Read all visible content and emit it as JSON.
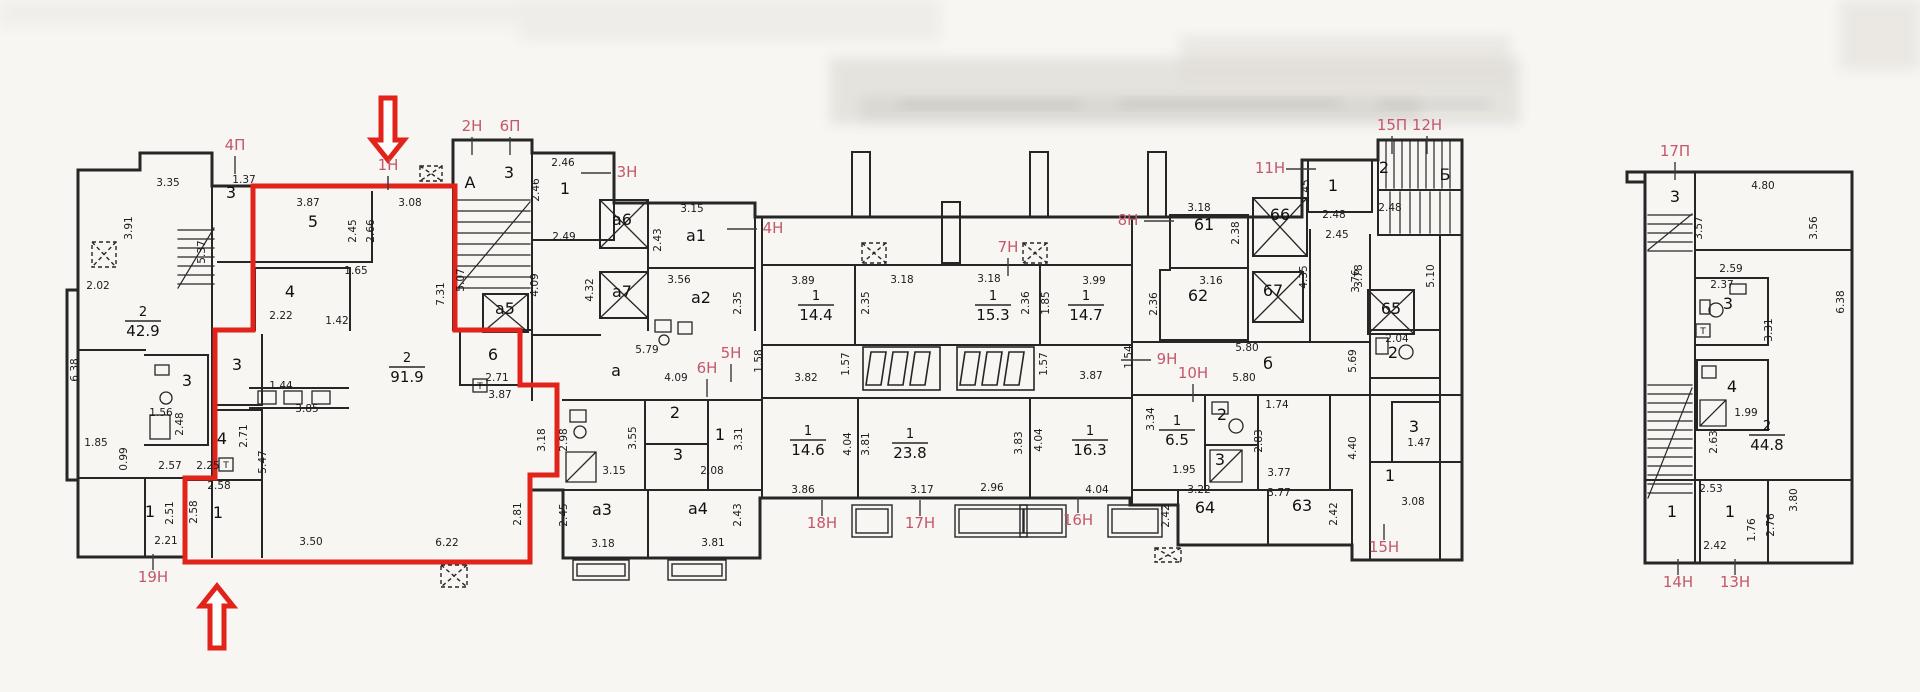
{
  "document": {
    "kind": "scanned floor plan"
  },
  "colors": {
    "paper": "#f7f6f3",
    "wall": "#262626",
    "red": "#e2231a",
    "red_label": "#c4576a",
    "tick": "#3a3a3a"
  },
  "plan": {
    "unit_outline": "M253,186 L455,186 L455,330 L520,330 L520,385 L557,385 L557,475 L530,475 L530,562 L185,562 L185,478 L215,478 L215,330 L253,330 Z",
    "arrows": [
      {
        "x": 388,
        "y": 98,
        "len": 62,
        "dir": "down"
      },
      {
        "x": 217,
        "y": 648,
        "len": 62,
        "dir": "up"
      }
    ],
    "red_labels": [
      [
        "4П",
        235,
        150,
        "d"
      ],
      [
        "2Н",
        472,
        131,
        "d"
      ],
      [
        "6П",
        510,
        131,
        "d"
      ],
      [
        "1Н",
        388,
        170,
        ""
      ],
      [
        "3Н",
        627,
        177,
        "l"
      ],
      [
        "4Н",
        773,
        233,
        "l"
      ],
      [
        "5Н",
        731,
        358,
        "d"
      ],
      [
        "6Н",
        707,
        373,
        "d"
      ],
      [
        "7Н",
        1008,
        252,
        "d"
      ],
      [
        "8Н",
        1128,
        225,
        "r"
      ],
      [
        "9Н",
        1167,
        364,
        "l"
      ],
      [
        "10Н",
        1193,
        378,
        "d"
      ],
      [
        "11Н",
        1270,
        173,
        "r"
      ],
      [
        "15П",
        1392,
        130,
        "d"
      ],
      [
        "12Н",
        1427,
        130,
        "d"
      ],
      [
        "16Н",
        1078,
        525,
        "u"
      ],
      [
        "17Н",
        920,
        528,
        "u"
      ],
      [
        "18Н",
        822,
        528,
        "u"
      ],
      [
        "19Н",
        153,
        582,
        "u"
      ],
      [
        "15Н",
        1384,
        552,
        "u"
      ],
      [
        "17П",
        1675,
        156,
        "d"
      ],
      [
        "14Н",
        1678,
        587,
        "u"
      ],
      [
        "13Н",
        1735,
        587,
        "u"
      ]
    ],
    "rooms": [
      [
        "3",
        231,
        198
      ],
      [
        "3",
        187,
        386
      ],
      [
        "1",
        150,
        517
      ],
      [
        "5",
        313,
        227
      ],
      [
        "4",
        290,
        297
      ],
      [
        "3",
        237,
        370
      ],
      [
        "4",
        222,
        444
      ],
      [
        "1",
        218,
        518
      ],
      [
        "6",
        493,
        360
      ],
      [
        "А",
        470,
        188
      ],
      [
        "3",
        509,
        178
      ],
      [
        "1",
        565,
        194
      ],
      [
        "а5",
        505,
        314
      ],
      [
        "а6",
        622,
        225
      ],
      [
        "а7",
        622,
        297
      ],
      [
        "а1",
        696,
        241
      ],
      [
        "а2",
        701,
        303
      ],
      [
        "а",
        616,
        376
      ],
      [
        "а3",
        602,
        515
      ],
      [
        "а4",
        698,
        514
      ],
      [
        "2",
        675,
        418
      ],
      [
        "3",
        678,
        460
      ],
      [
        "1",
        720,
        440
      ],
      [
        "61",
        1204,
        230
      ],
      [
        "62",
        1198,
        301
      ],
      [
        "66",
        1280,
        220
      ],
      [
        "67",
        1273,
        296
      ],
      [
        "65",
        1391,
        314
      ],
      [
        "64",
        1205,
        513
      ],
      [
        "63",
        1302,
        511
      ],
      [
        "б",
        1268,
        369
      ],
      [
        "1",
        1333,
        191
      ],
      [
        "2",
        1222,
        420
      ],
      [
        "3",
        1220,
        465
      ],
      [
        "2",
        1393,
        358
      ],
      [
        "3",
        1414,
        432
      ],
      [
        "1",
        1390,
        481
      ],
      [
        "Б",
        1445,
        180
      ],
      [
        "2",
        1384,
        173
      ],
      [
        "3",
        1675,
        202
      ],
      [
        "3",
        1728,
        309
      ],
      [
        "4",
        1732,
        392
      ],
      [
        "1",
        1672,
        517
      ],
      [
        "1",
        1730,
        517
      ]
    ],
    "areas": [
      [
        "2",
        "42.9",
        143,
        316
      ],
      [
        "2",
        "91.9",
        407,
        362
      ],
      [
        "1",
        "14.4",
        816,
        300
      ],
      [
        "1",
        "15.3",
        993,
        300
      ],
      [
        "1",
        "14.7",
        1086,
        300
      ],
      [
        "1",
        "14.6",
        808,
        435
      ],
      [
        "1",
        "23.8",
        910,
        438
      ],
      [
        "1",
        "16.3",
        1090,
        435
      ],
      [
        "1",
        "6.5",
        1177,
        425
      ],
      [
        "2",
        "44.8",
        1767,
        430
      ]
    ],
    "dims": [
      [
        "3.35",
        168,
        186,
        0
      ],
      [
        "1.37",
        244,
        183,
        0
      ],
      [
        "3.91",
        132,
        228,
        1
      ],
      [
        "5.37",
        205,
        252,
        1
      ],
      [
        "2.02",
        98,
        289,
        0
      ],
      [
        "6.38",
        78,
        370,
        1
      ],
      [
        "1.85",
        96,
        446,
        0
      ],
      [
        "0.99",
        127,
        459,
        1
      ],
      [
        "2.57",
        170,
        469,
        0
      ],
      [
        "2.48",
        183,
        424,
        1
      ],
      [
        "1.56",
        161,
        416,
        0
      ],
      [
        "2.51",
        173,
        513,
        1
      ],
      [
        "2.21",
        166,
        544,
        0
      ],
      [
        "3.87",
        308,
        206,
        0
      ],
      [
        "3.08",
        410,
        206,
        0
      ],
      [
        "2.45",
        356,
        231,
        1
      ],
      [
        "2.66",
        374,
        231,
        1
      ],
      [
        "7.31",
        444,
        294,
        1
      ],
      [
        "2.22",
        281,
        319,
        0
      ],
      [
        "1.65",
        356,
        274,
        0
      ],
      [
        "1.42",
        337,
        324,
        0
      ],
      [
        "1.44",
        281,
        389,
        0
      ],
      [
        "3.85",
        307,
        412,
        0
      ],
      [
        "2.71",
        247,
        436,
        1
      ],
      [
        "2.25",
        208,
        469,
        0
      ],
      [
        "2.58",
        219,
        489,
        0
      ],
      [
        "2.58",
        197,
        512,
        1
      ],
      [
        "5.47",
        266,
        462,
        1
      ],
      [
        "3.50",
        311,
        545,
        0
      ],
      [
        "6.22",
        447,
        546,
        0
      ],
      [
        "2.81",
        521,
        514,
        1
      ],
      [
        "2.71",
        497,
        381,
        0
      ],
      [
        "3.87",
        500,
        398,
        0
      ],
      [
        "5.07",
        464,
        280,
        1
      ],
      [
        "2.46",
        563,
        166,
        0
      ],
      [
        "2.46",
        539,
        190,
        1
      ],
      [
        "2.49",
        564,
        240,
        0
      ],
      [
        "4.09",
        538,
        285,
        1
      ],
      [
        "4.32",
        593,
        290,
        1
      ],
      [
        "2.43",
        661,
        240,
        1
      ],
      [
        "3.15",
        692,
        212,
        0
      ],
      [
        "3.56",
        679,
        283,
        0
      ],
      [
        "2.35",
        741,
        303,
        1
      ],
      [
        "5.79",
        647,
        353,
        0
      ],
      [
        "1.58",
        762,
        361,
        1
      ],
      [
        "4.09",
        676,
        381,
        0
      ],
      [
        "3.82",
        806,
        381,
        0
      ],
      [
        "3.55",
        636,
        438,
        1
      ],
      [
        "3.31",
        742,
        439,
        1
      ],
      [
        "3.15",
        614,
        474,
        0
      ],
      [
        "2.08",
        712,
        474,
        0
      ],
      [
        "3.18",
        545,
        440,
        1
      ],
      [
        "2.98",
        567,
        440,
        1
      ],
      [
        "2.45",
        567,
        515,
        1
      ],
      [
        "3.18",
        603,
        547,
        0
      ],
      [
        "3.81",
        713,
        546,
        0
      ],
      [
        "2.43",
        741,
        515,
        1
      ],
      [
        "3.86",
        803,
        493,
        0
      ],
      [
        "3.17",
        922,
        493,
        0
      ],
      [
        "2.96",
        992,
        491,
        0
      ],
      [
        "4.04",
        1097,
        493,
        0
      ],
      [
        "3.89",
        803,
        284,
        0
      ],
      [
        "3.18",
        902,
        283,
        0
      ],
      [
        "3.18",
        989,
        282,
        0
      ],
      [
        "2.35",
        869,
        303,
        1
      ],
      [
        "2.36",
        1029,
        303,
        1
      ],
      [
        "1.85",
        1049,
        303,
        1
      ],
      [
        "3.99",
        1094,
        284,
        0
      ],
      [
        "1.57",
        849,
        364,
        1
      ],
      [
        "1.57",
        1047,
        364,
        1
      ],
      [
        "3.87",
        1091,
        379,
        0
      ],
      [
        "1.54",
        1132,
        357,
        1
      ],
      [
        "4.04",
        851,
        444,
        1
      ],
      [
        "3.81",
        869,
        444,
        1
      ],
      [
        "3.83",
        1022,
        443,
        1
      ],
      [
        "4.04",
        1042,
        440,
        1
      ],
      [
        "3.18",
        1199,
        211,
        0
      ],
      [
        "2.38",
        1239,
        233,
        1
      ],
      [
        "3.16",
        1211,
        284,
        0
      ],
      [
        "2.36",
        1157,
        304,
        1
      ],
      [
        "2.45",
        1309,
        191,
        1
      ],
      [
        "2.48",
        1334,
        218,
        0
      ],
      [
        "2.45",
        1337,
        238,
        0
      ],
      [
        "4.35",
        1307,
        277,
        1
      ],
      [
        "3.76",
        1359,
        281,
        1
      ],
      [
        "5.80",
        1247,
        351,
        0
      ],
      [
        "5.80",
        1244,
        381,
        0
      ],
      [
        "3.34",
        1154,
        419,
        1
      ],
      [
        "1.95",
        1184,
        473,
        0
      ],
      [
        "2.83",
        1262,
        441,
        1
      ],
      [
        "1.74",
        1277,
        408,
        0
      ],
      [
        "3.77",
        1279,
        476,
        0
      ],
      [
        "3.77",
        1279,
        496,
        0
      ],
      [
        "3.22",
        1199,
        493,
        0
      ],
      [
        "2.42",
        1169,
        516,
        1
      ],
      [
        "2.42",
        1337,
        514,
        1
      ],
      [
        "3.78",
        1362,
        276,
        1
      ],
      [
        "5.69",
        1356,
        361,
        1
      ],
      [
        "5.10",
        1434,
        276,
        1
      ],
      [
        "2.48",
        1390,
        211,
        0
      ],
      [
        "2.04",
        1397,
        342,
        0
      ],
      [
        "4.40",
        1356,
        448,
        1
      ],
      [
        "1.47",
        1419,
        446,
        0
      ],
      [
        "3.08",
        1413,
        505,
        0
      ],
      [
        "4.80",
        1763,
        189,
        0
      ],
      [
        "3.57",
        1702,
        228,
        1
      ],
      [
        "3.56",
        1817,
        228,
        1
      ],
      [
        "2.59",
        1731,
        272,
        0
      ],
      [
        "2.37",
        1722,
        288,
        0
      ],
      [
        "3.31",
        1772,
        330,
        1
      ],
      [
        "1.99",
        1746,
        416,
        0
      ],
      [
        "2.63",
        1717,
        442,
        1
      ],
      [
        "2.53",
        1711,
        492,
        0
      ],
      [
        "2.42",
        1715,
        549,
        0
      ],
      [
        "1.76",
        1755,
        530,
        1
      ],
      [
        "2.76",
        1774,
        525,
        1
      ],
      [
        "3.80",
        1797,
        500,
        1
      ],
      [
        "6.38",
        1844,
        302,
        1
      ]
    ],
    "t_marks": [
      [
        480,
        389
      ],
      [
        226,
        468
      ],
      [
        1703,
        334
      ]
    ]
  }
}
